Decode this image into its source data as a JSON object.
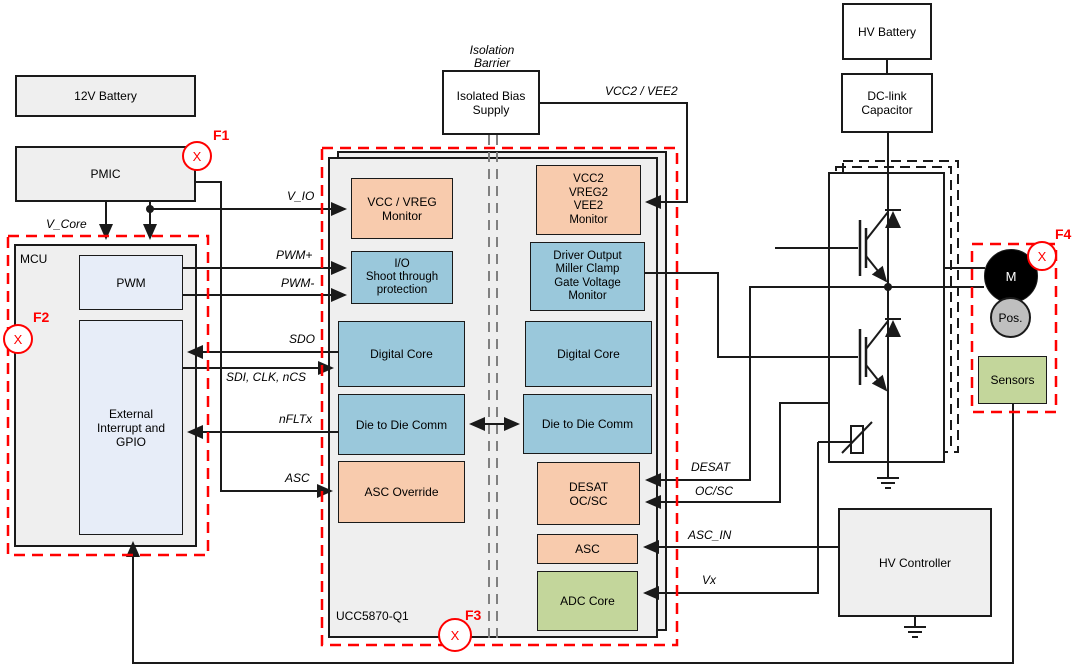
{
  "colors": {
    "panel_gray": "#EFEFEF",
    "block_orange": "#F8CBAD",
    "block_blue": "#9AC8DB",
    "block_green": "#C3D69B",
    "mcu_block_blue": "#E7EDF8",
    "fault_red": "#FF0000",
    "line_black": "#1A1A1A",
    "barrier_gray": "#808080",
    "motor_black": "#000000",
    "pos_gray": "#BFBFBF"
  },
  "power_chain": {
    "battery_12v": "12V Battery",
    "pmic": "PMIC"
  },
  "mcu": {
    "label": "MCU",
    "pwm": "PWM",
    "gpio": "External\nInterrupt and\nGPIO"
  },
  "isolation": {
    "barrier_label": "Isolation\nBarrier",
    "bias_supply": "Isolated Bias\nSupply"
  },
  "gate_driver": {
    "part_number": "UCC5870-Q1",
    "low_side": {
      "vcc_monitor": "VCC / VREG\nMonitor",
      "io_protection": "I/O\nShoot through\nprotection",
      "digital_core": "Digital Core",
      "die_comm": "Die to Die Comm",
      "asc_override": "ASC Override"
    },
    "high_side": {
      "vcc2_monitor": "VCC2\nVREG2\nVEE2\nMonitor",
      "driver_output": "Driver Output\nMiller Clamp\nGate Voltage\nMonitor",
      "digital_core": "Digital Core",
      "die_comm": "Die to Die Comm",
      "desat": "DESAT\nOC/SC",
      "asc": "ASC",
      "adc_core": "ADC Core"
    }
  },
  "signals": {
    "v_core": "V_Core",
    "v_io": "V_IO",
    "pwm_plus": "PWM+",
    "pwm_minus": "PWM-",
    "sdo": "SDO",
    "spi": "SDI, CLK, nCS",
    "nfltx": "nFLTx",
    "asc": "ASC",
    "vcc2_vee2": "VCC2 / VEE2",
    "desat": "DESAT",
    "oc_sc": "OC/SC",
    "asc_in": "ASC_IN",
    "vx": "Vx"
  },
  "hv_side": {
    "hv_battery": "HV Battery",
    "dc_link": "DC-link\nCapacitor",
    "motor": "M",
    "position_sensor": "Pos.",
    "sensors": "Sensors",
    "hv_controller": "HV Controller"
  },
  "faults": {
    "marker": "X",
    "f1": "F1",
    "f2": "F2",
    "f3": "F3",
    "f4": "F4"
  }
}
